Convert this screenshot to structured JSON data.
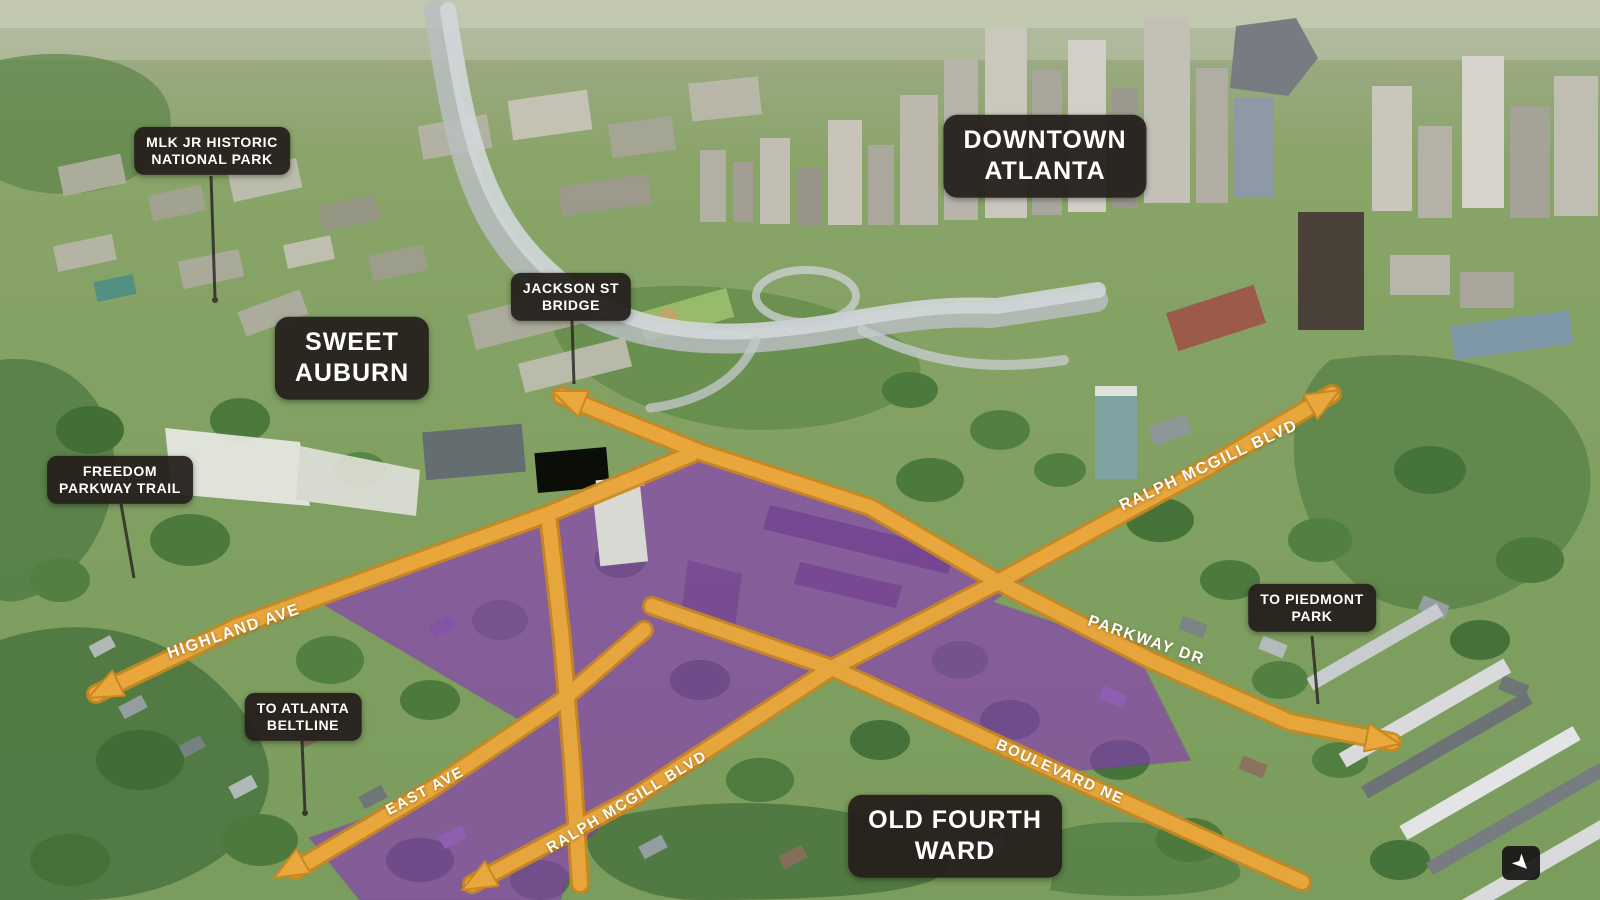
{
  "map": {
    "title": "Annotated aerial map of the Old Fourth Ward medical-center site, Atlanta",
    "place_labels": [
      {
        "id": "mlk-park",
        "line1": "MLK JR HISTORIC",
        "line2": "NATIONAL PARK"
      },
      {
        "id": "downtown",
        "line1": "DOWNTOWN",
        "line2": "ATLANTA"
      },
      {
        "id": "jackson-bridge",
        "line1": "JACKSON ST",
        "line2": "BRIDGE"
      },
      {
        "id": "sweet-auburn",
        "line1": "SWEET",
        "line2": "AUBURN"
      },
      {
        "id": "freedom-trail",
        "line1": "FREEDOM",
        "line2": "PARKWAY TRAIL"
      },
      {
        "id": "beltline",
        "line1": "TO ATLANTA",
        "line2": "BELTLINE"
      },
      {
        "id": "piedmont",
        "line1": "TO PIEDMONT",
        "line2": "PARK"
      },
      {
        "id": "old-fourth-ward",
        "line1": "OLD FOURTH",
        "line2": "WARD"
      }
    ],
    "street_labels": [
      {
        "id": "highland",
        "text": "HIGHLAND AVE"
      },
      {
        "id": "east-ave",
        "text": "EAST AVE"
      },
      {
        "id": "ralph-mcgill-south",
        "text": "RALPH MCGILL BLVD"
      },
      {
        "id": "ralph-mcgill-east",
        "text": "RALPH MCGILL BLVD"
      },
      {
        "id": "parkway-dr",
        "text": "PARKWAY DR"
      },
      {
        "id": "boulevard-ne",
        "text": "BOULEVARD NE"
      }
    ],
    "icons": [
      {
        "name": "se-arrow-badge",
        "glyph": "➤"
      }
    ],
    "colors": {
      "road": "#E9A73E",
      "road_edge": "#C9881F",
      "site_highlight": "#8A36BC",
      "label_background": "#26211E",
      "label_text": "#FFFFFF"
    }
  }
}
